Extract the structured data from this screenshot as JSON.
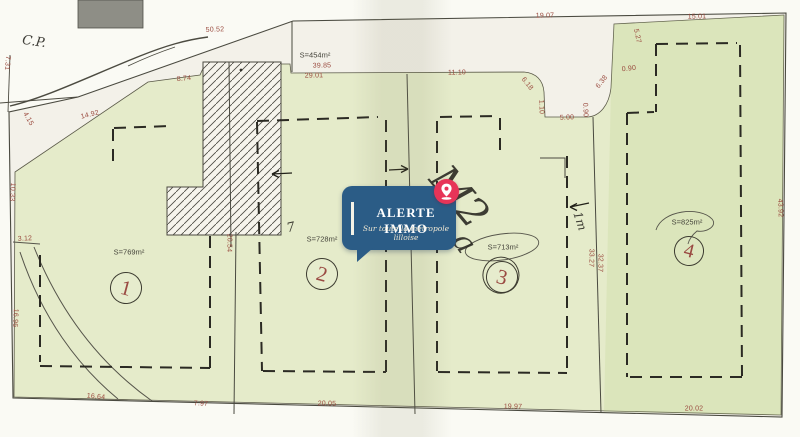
{
  "watermark": {
    "title": "ALERTE IMMO",
    "tagline": "Sur toute la métropole lilloise"
  },
  "colors": {
    "badge_blue": "#2b5c86",
    "pin_pink": "#e73458",
    "parcel_green": "#e5ebca",
    "paper": "#f3f1e9",
    "dimension_red": "#9a4a3e",
    "ink": "#3f3e33"
  },
  "plot_numbers": [
    {
      "n": "1",
      "x": 126,
      "y": 288,
      "r": 15,
      "area": "S=769m²"
    },
    {
      "n": "2",
      "x": 322,
      "y": 274,
      "r": 15,
      "area": "S=728m²"
    },
    {
      "n": "3",
      "x": 502,
      "y": 277,
      "r": 15,
      "double": true,
      "area": "S=713m²"
    },
    {
      "n": "4",
      "x": 689,
      "y": 251,
      "r": 14,
      "area": "S=825m²"
    }
  ],
  "area_labels": [
    {
      "t": "S=454m²",
      "x": 315,
      "y": 55
    },
    {
      "t": "S=769m²",
      "x": 129,
      "y": 252
    },
    {
      "t": "S=728m²",
      "x": 322,
      "y": 239
    },
    {
      "t": "S=713m²",
      "x": 503,
      "y": 247
    },
    {
      "t": "S=825m²",
      "x": 687,
      "y": 222
    }
  ],
  "dimensions": [
    {
      "t": "50.52",
      "x": 215,
      "y": 30,
      "r": -2
    },
    {
      "t": "7.31",
      "x": 7,
      "y": 63,
      "r": 95
    },
    {
      "t": "4.15",
      "x": 28,
      "y": 119,
      "r": 60
    },
    {
      "t": "14.92",
      "x": 90,
      "y": 115,
      "r": -14
    },
    {
      "t": "8.74",
      "x": 184,
      "y": 79,
      "r": -5
    },
    {
      "t": "10.33",
      "x": 12,
      "y": 192,
      "r": 93
    },
    {
      "t": "3.12",
      "x": 25,
      "y": 239,
      "r": -3
    },
    {
      "t": "16.96",
      "x": 15,
      "y": 318,
      "r": 93
    },
    {
      "t": "20.54",
      "x": 229,
      "y": 243,
      "r": 91
    },
    {
      "t": "16.64",
      "x": 96,
      "y": 397,
      "r": 5
    },
    {
      "t": "7.97",
      "x": 201,
      "y": 404,
      "r": 2
    },
    {
      "t": "20.05",
      "x": 327,
      "y": 404,
      "r": 1
    },
    {
      "t": "19.97",
      "x": 513,
      "y": 407,
      "r": 1
    },
    {
      "t": "20.02",
      "x": 694,
      "y": 409,
      "r": 0
    },
    {
      "t": "39.85",
      "x": 322,
      "y": 66,
      "r": -1
    },
    {
      "t": "29.01",
      "x": 314,
      "y": 76,
      "r": -1
    },
    {
      "t": "11.10",
      "x": 457,
      "y": 73,
      "r": -1
    },
    {
      "t": "6.18",
      "x": 527,
      "y": 84,
      "r": 52
    },
    {
      "t": "1.10",
      "x": 541,
      "y": 107,
      "r": 88
    },
    {
      "t": "5.00",
      "x": 567,
      "y": 118,
      "r": -2
    },
    {
      "t": "0.90",
      "x": 585,
      "y": 110,
      "r": 88
    },
    {
      "t": "6.38",
      "x": 602,
      "y": 82,
      "r": -52
    },
    {
      "t": "19.07",
      "x": 545,
      "y": 16,
      "r": -1
    },
    {
      "t": "5.27",
      "x": 637,
      "y": 36,
      "r": 78
    },
    {
      "t": "0.90",
      "x": 629,
      "y": 69,
      "r": -6
    },
    {
      "t": "15.01",
      "x": 697,
      "y": 17,
      "r": -1
    },
    {
      "t": "33.27",
      "x": 591,
      "y": 258,
      "r": 91
    },
    {
      "t": "32.37",
      "x": 600,
      "y": 263,
      "r": 91
    },
    {
      "t": "43.92",
      "x": 780,
      "y": 208,
      "r": 88
    }
  ],
  "annotations": [
    {
      "t": "C.P.",
      "x": 34,
      "y": 42,
      "r": 8,
      "s": 13
    },
    {
      "t": "M2",
      "x": 459,
      "y": 197,
      "r": 50,
      "s": 40
    },
    {
      "t": "a",
      "x": 464,
      "y": 243,
      "r": 55,
      "s": 30
    },
    {
      "t": "1m",
      "x": 580,
      "y": 221,
      "r": 72,
      "s": 12
    },
    {
      "t": "7",
      "x": 291,
      "y": 228,
      "r": -12,
      "s": 13
    }
  ]
}
